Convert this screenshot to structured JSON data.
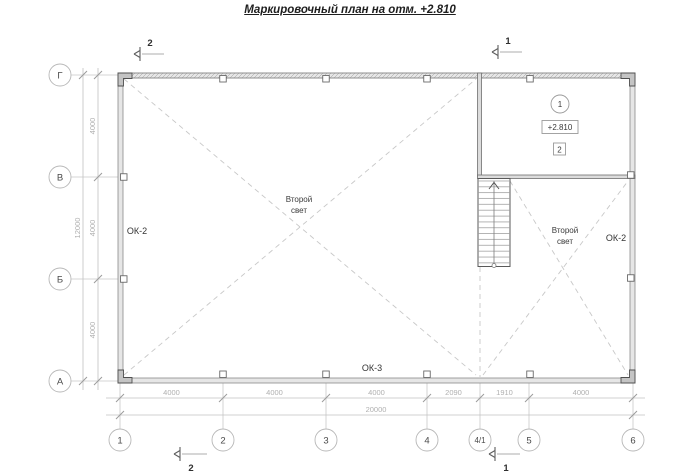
{
  "title": "Маркировочный план на отм. +2.810",
  "colors": {
    "line_grey": "#c2c2c2",
    "dim_text": "#b0b0b0",
    "text_dark": "#3a3a3a",
    "wall_fill": "#e6e6e6"
  },
  "axes": {
    "vertical": [
      "Г",
      "В",
      "Б",
      "А"
    ],
    "horizontal": [
      "1",
      "2",
      "3",
      "4",
      "4/1",
      "5",
      "6"
    ]
  },
  "dimensions": {
    "bottom_segments": [
      "4000",
      "4000",
      "4000",
      "2090",
      "1910",
      "4000"
    ],
    "bottom_total": "20000",
    "left_segments": [
      "4000",
      "4000",
      "4000"
    ],
    "left_total": "12000"
  },
  "sections": {
    "top_left": "2",
    "top_right": "1",
    "bottom_left": "2",
    "bottom_right": "1"
  },
  "windows": {
    "left": "ОК-2",
    "right": "ОК-2",
    "bottom": "ОК-3"
  },
  "rooms": {
    "second_light_left": [
      "Второй",
      "свет"
    ],
    "second_light_right": [
      "Второй",
      "свет"
    ]
  },
  "marks": {
    "room_number": "1",
    "elevation": "+2.810",
    "detail_number": "2"
  }
}
